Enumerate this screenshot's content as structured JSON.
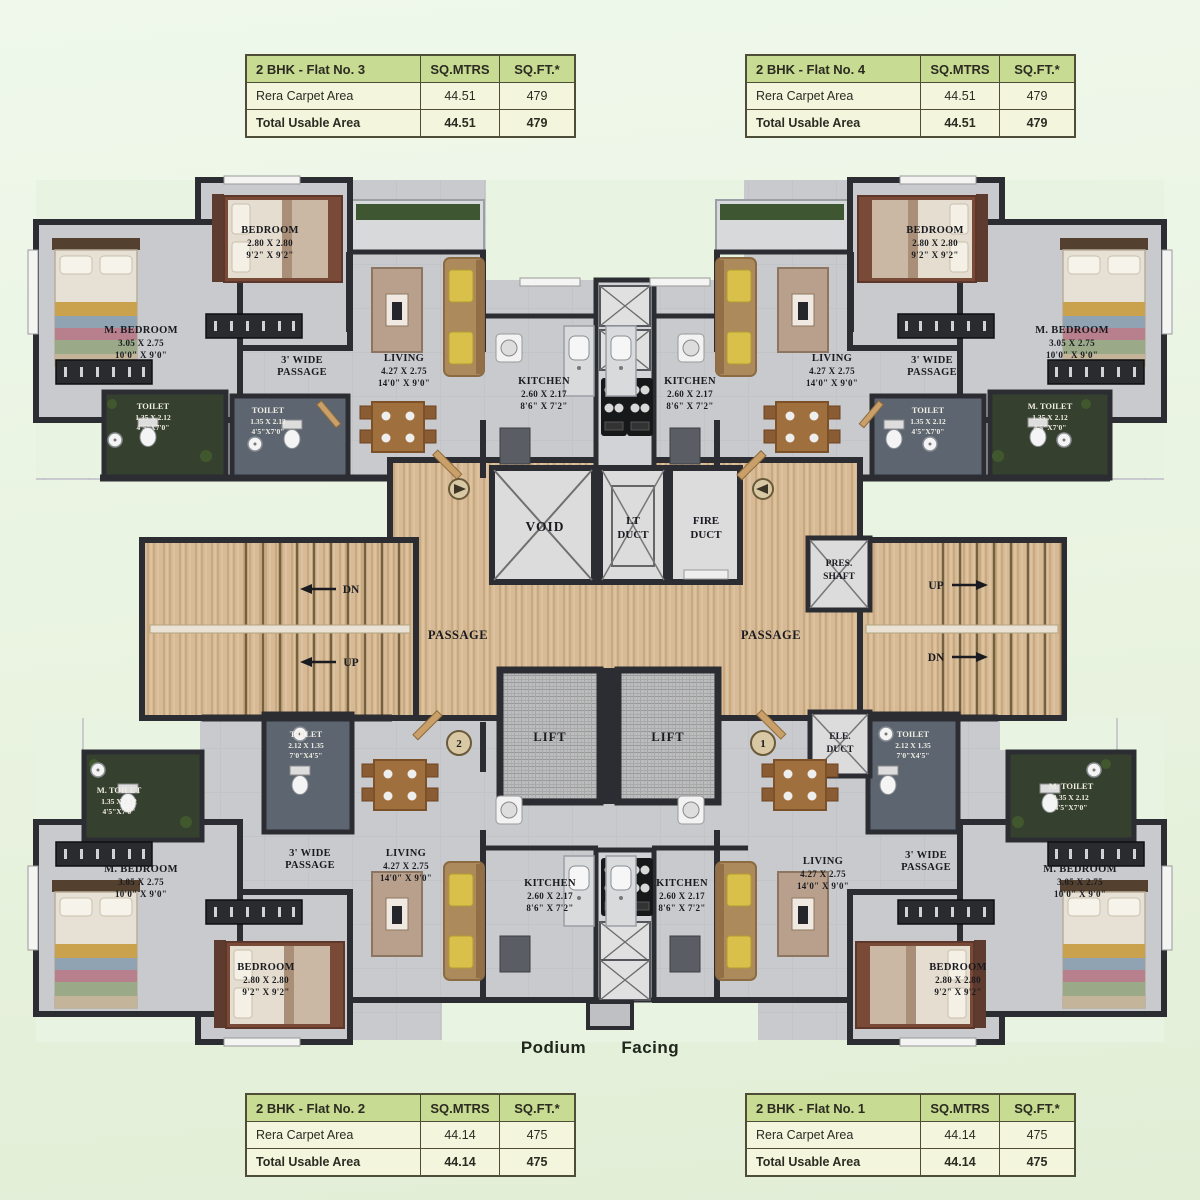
{
  "page": {
    "footer_label": "Podium Facing"
  },
  "tables": [
    {
      "title": "2 BHK - Flat No. 3",
      "col_sqm": "SQ.MTRS",
      "col_sqft": "SQ.FT.*",
      "rows": [
        [
          "Rera Carpet Area",
          "44.51",
          "479"
        ],
        [
          "Total Usable Area",
          "44.51",
          "479"
        ]
      ]
    },
    {
      "title": "2 BHK - Flat No. 4",
      "col_sqm": "SQ.MTRS",
      "col_sqft": "SQ.FT.*",
      "rows": [
        [
          "Rera Carpet Area",
          "44.51",
          "479"
        ],
        [
          "Total Usable Area",
          "44.51",
          "479"
        ]
      ]
    },
    {
      "title": "2 BHK - Flat No. 2",
      "col_sqm": "SQ.MTRS",
      "col_sqft": "SQ.FT.*",
      "rows": [
        [
          "Rera Carpet Area",
          "44.14",
          "475"
        ],
        [
          "Total Usable Area",
          "44.14",
          "475"
        ]
      ]
    },
    {
      "title": "2 BHK - Flat No. 1",
      "col_sqm": "SQ.MTRS",
      "col_sqft": "SQ.FT.*",
      "rows": [
        [
          "Rera Carpet Area",
          "44.14",
          "475"
        ],
        [
          "Total Usable Area",
          "44.14",
          "475"
        ]
      ]
    }
  ],
  "rooms": {
    "m_bedroom": {
      "name": "M. BEDROOM",
      "dim_m": "3.05 X 2.75",
      "dim_ft": "10'0\" X 9'0\""
    },
    "bedroom": {
      "name": "BEDROOM",
      "dim_m": "2.80 X 2.80",
      "dim_ft": "9'2\" X 9'2\""
    },
    "living": {
      "name": "LIVING",
      "dim_m": "4.27 X 2.75",
      "dim_ft": "14'0\" X 9'0\""
    },
    "kitchen": {
      "name": "KITCHEN",
      "dim_m": "2.60 X 2.17",
      "dim_ft": "8'6\" X 7'2\""
    },
    "toilet": {
      "name": "TOILET",
      "dim_m": "1.35 X 2.12",
      "dim_ft": "4'5\"X7'0\""
    },
    "toilet_wide": {
      "name": "TOILET",
      "dim_m": "2.12 X 1.35",
      "dim_ft": "7'0\"X4'5\""
    },
    "m_toilet": {
      "name": "M. TOILET",
      "dim_m": "1.35 X 2.12",
      "dim_ft": "4'5\"X7'0\""
    },
    "passage_wide_l1": "3' WIDE",
    "passage_wide_l2": "PASSAGE",
    "passage": "PASSAGE"
  },
  "core": {
    "void": "VOID",
    "lt_duct_l1": "LT",
    "lt_duct_l2": "DUCT",
    "fire_duct_l1": "FIRE",
    "fire_duct_l2": "DUCT",
    "pres_shaft_l1": "PRES.",
    "pres_shaft_l2": "SHAFT",
    "ele_duct_l1": "ELE.",
    "ele_duct_l2": "DUCT",
    "lift": "LIFT",
    "up": "UP",
    "dn": "DN",
    "marker_left": "2",
    "marker_right": "1"
  }
}
